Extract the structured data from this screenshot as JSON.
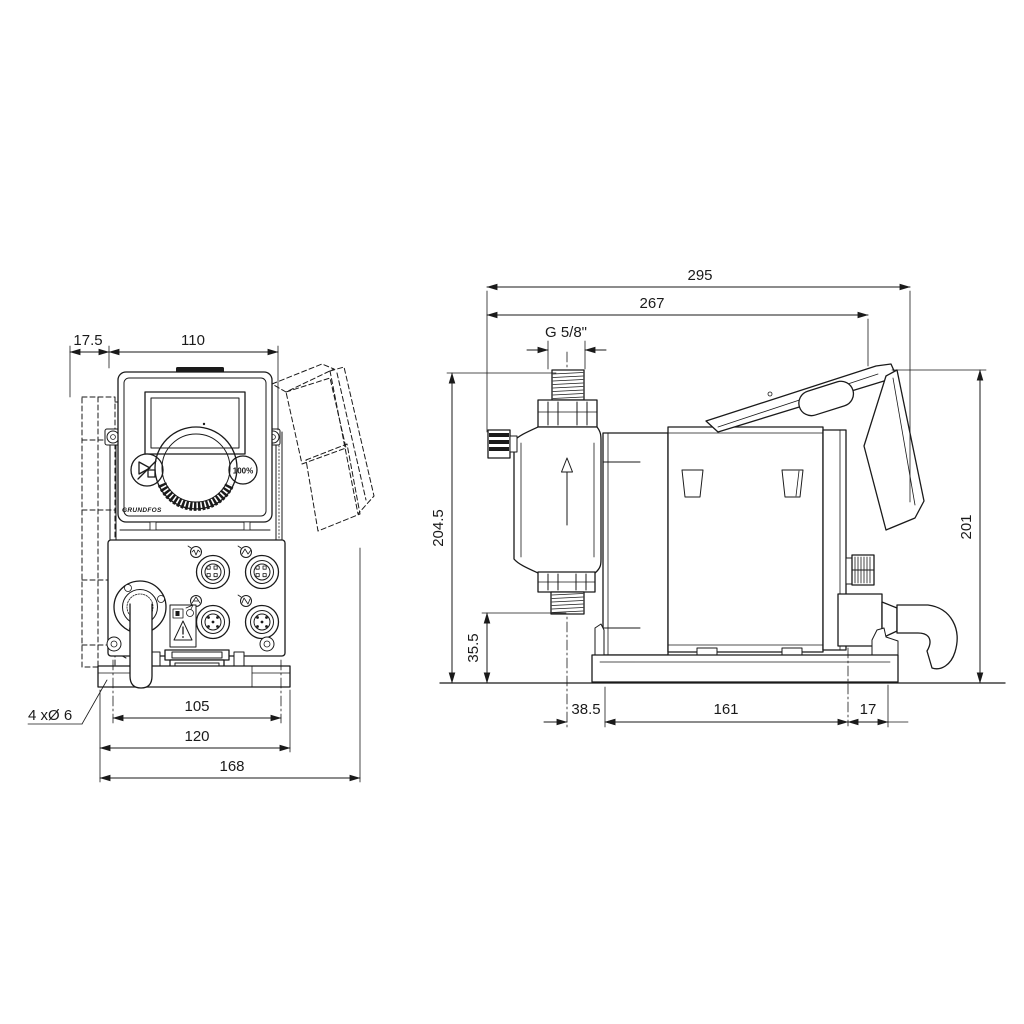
{
  "drawing_type": "dosing-pump-dimensional-drawing",
  "colors": {
    "line": "#1a1a1a",
    "background": "#ffffff"
  },
  "front_view": {
    "name": "front-view",
    "panel": {
      "brand": "GRUNDFOS",
      "max_capacity_label": "100%"
    },
    "dims": {
      "wall_plate_offset": "17.5",
      "panel_width": "110",
      "mounting_hole_spacing": "105",
      "base_plate_width": "120",
      "overall_width": "168",
      "mounting_holes_note": "4 xØ 6"
    }
  },
  "side_view": {
    "name": "side-view",
    "dims": {
      "overall_depth": "295",
      "body_depth": "267",
      "thread_size": "G 5/8\"",
      "height_to_connection": "204.5",
      "connection_clearance": "35.5",
      "overall_height": "201",
      "center_to_base": "38.5",
      "base_length": "161",
      "rear_offset": "17"
    }
  },
  "icons": {
    "start_stop": "play-stop",
    "flow_direction": "up-arrow",
    "warning": "exclamation-triangle"
  }
}
